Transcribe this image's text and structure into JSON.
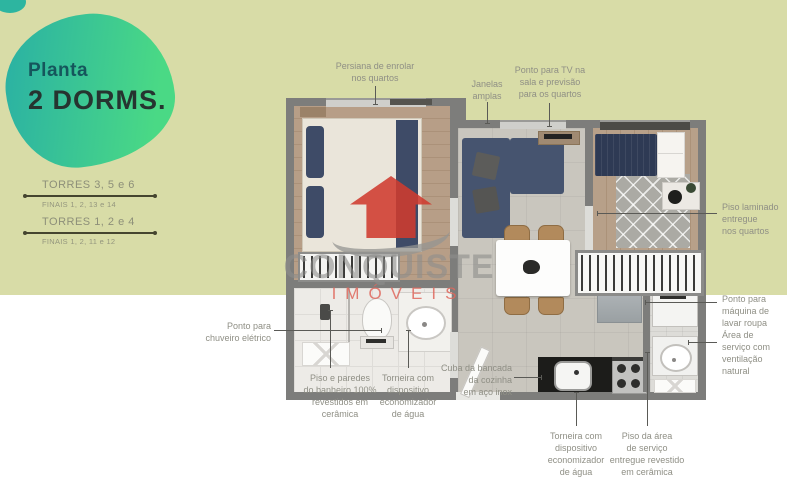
{
  "heading": {
    "kicker": "Planta",
    "title": "2 DORMS."
  },
  "legend": {
    "rows": [
      {
        "torres": "TORRES 3, 5 e 6",
        "finais": "FINAIS 1, 2, 13 e 14"
      },
      {
        "torres": "TORRES 1, 2 e 4",
        "finais": "FINAIS 1, 2, 11 e 12"
      }
    ]
  },
  "watermark": {
    "brand": "CONQUISTE",
    "sub": "IMÓVEIS"
  },
  "annotations": {
    "persiana": "Persiana de enrolar\nnos quartos",
    "janelas": "Janelas\namplas",
    "tv": "Ponto para TV na\nsala e previsão\npara os quartos",
    "piso_laminado": "Piso laminado\nentregue\nnos quartos",
    "maquina": "Ponto para\nmáquina de\nlavar roupa",
    "area_servico": "Área de\nserviço com\nventilação\nnatural",
    "chuveiro": "Ponto para\nchuveiro elétrico",
    "piso_banheiro": "Piso e paredes\ndo banheiro 100%\nrevestidos em\ncerâmica",
    "torneira_banheiro": "Torneira com\ndispositivo\neconomizador\nde água",
    "cuba": "Cuba da bancada\nda cozinha\nem aço inox",
    "torneira_cozinha": "Torneira com\ndispositivo\neconomizador\nde água",
    "piso_servico": "Piso da área\nde serviço\nentregue revestido\nem cerâmica"
  },
  "colors": {
    "background_top": "#d8dca7",
    "background_bottom": "#ffffff",
    "blob_gradient_start": "#2cb3a2",
    "blob_gradient_end": "#4ad985",
    "kicker_text": "#15565c",
    "title_text": "#263430",
    "legend_text": "#8d8f79",
    "annotation_text": "#8f8f85",
    "leader_line": "#5a5a56",
    "wall": "#7d7d7b",
    "watermark_brand": "#8e8e8c",
    "watermark_sub": "#e0685d",
    "watermark_logo": "#cf3b2f"
  }
}
